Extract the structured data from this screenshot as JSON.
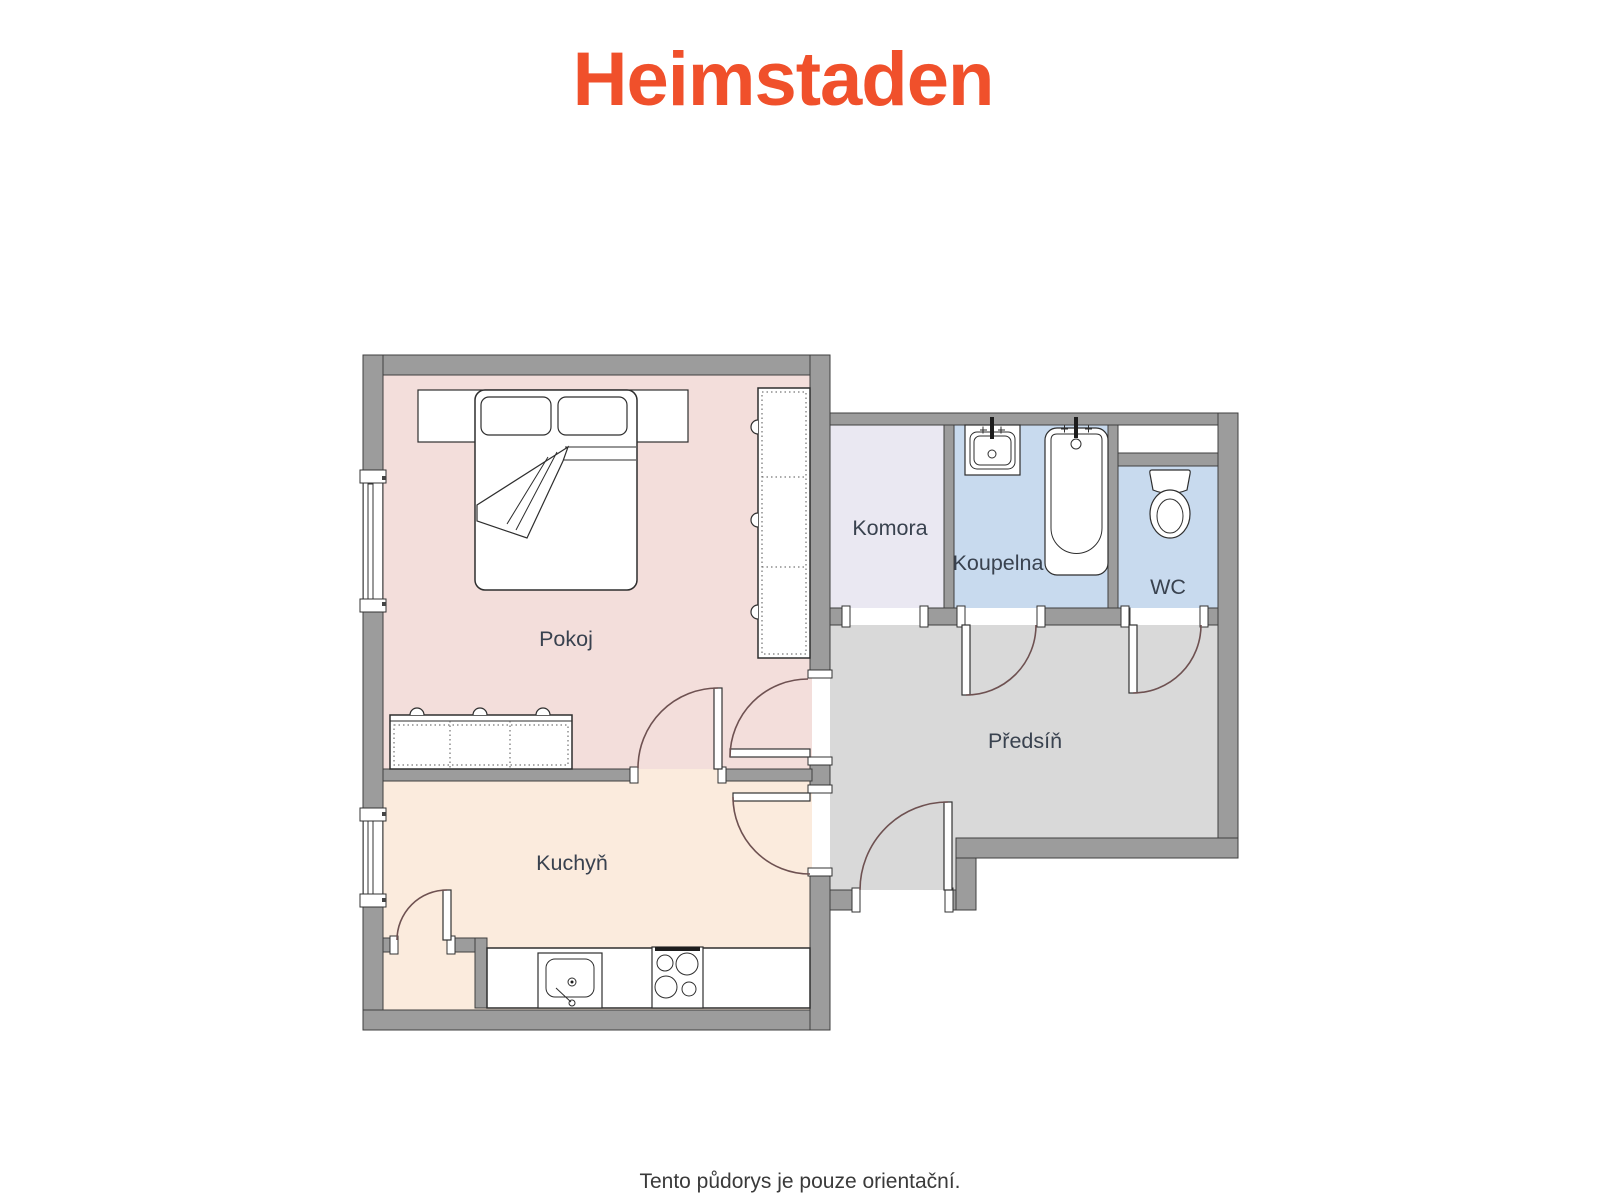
{
  "logo": {
    "text": "Heimstaden",
    "color": "#F0502B"
  },
  "caption": {
    "text": "Tento půdorys je pouze orientační.",
    "color": "#3A3A3A"
  },
  "floorplan": {
    "wall_color": "#9C9C9C",
    "door_arc_color": "#6E5151",
    "label_color": "#39424F",
    "rooms": [
      {
        "name": "Pokoj",
        "fill": "#F3DEDB"
      },
      {
        "name": "Kuchyň",
        "fill": "#FBEBDD"
      },
      {
        "name": "Komora",
        "fill": "#EAE8F2"
      },
      {
        "name": "Koupelna",
        "fill": "#C8DAEE"
      },
      {
        "name": "WC",
        "fill": "#C8DAEE"
      },
      {
        "name": "Předsíň",
        "fill": "#D9D9D9"
      }
    ],
    "fixtures": [
      "double-bed",
      "pillows",
      "wardrobe",
      "dresser",
      "kitchen-counter",
      "kitchen-sink",
      "stove",
      "bathroom-sink",
      "bathtub",
      "toilet",
      "windows",
      "doors"
    ]
  }
}
